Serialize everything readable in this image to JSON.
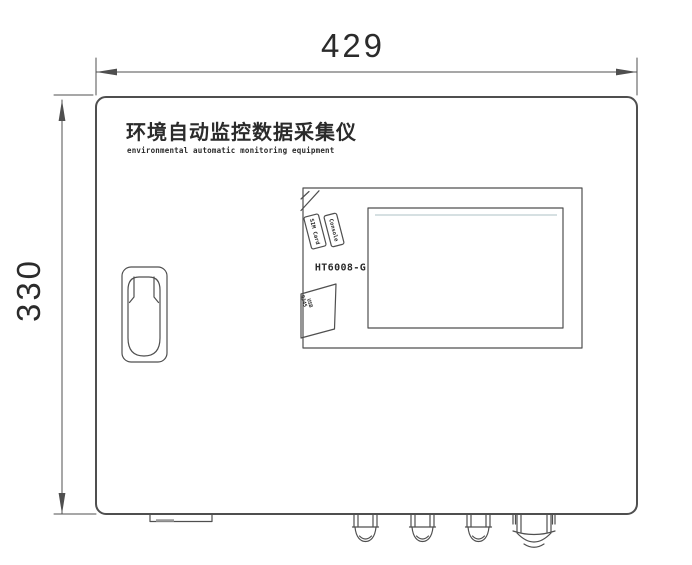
{
  "device": {
    "title_cn": "环境自动监控数据采集仪",
    "title_en": "environmental automatic monitoring equipment",
    "model": "HT6008-G"
  },
  "dimensions": {
    "width_value": "429",
    "height_value": "330"
  },
  "port_labels": {
    "console": "Console",
    "sim_card": "SIM Card",
    "bottom_a": "RJ45",
    "bottom_b": "USB"
  },
  "colors": {
    "line": "#4f4f4f",
    "text": "#2b2b2b",
    "screen_accent": "#c9d5d9",
    "background": "#ffffff"
  }
}
